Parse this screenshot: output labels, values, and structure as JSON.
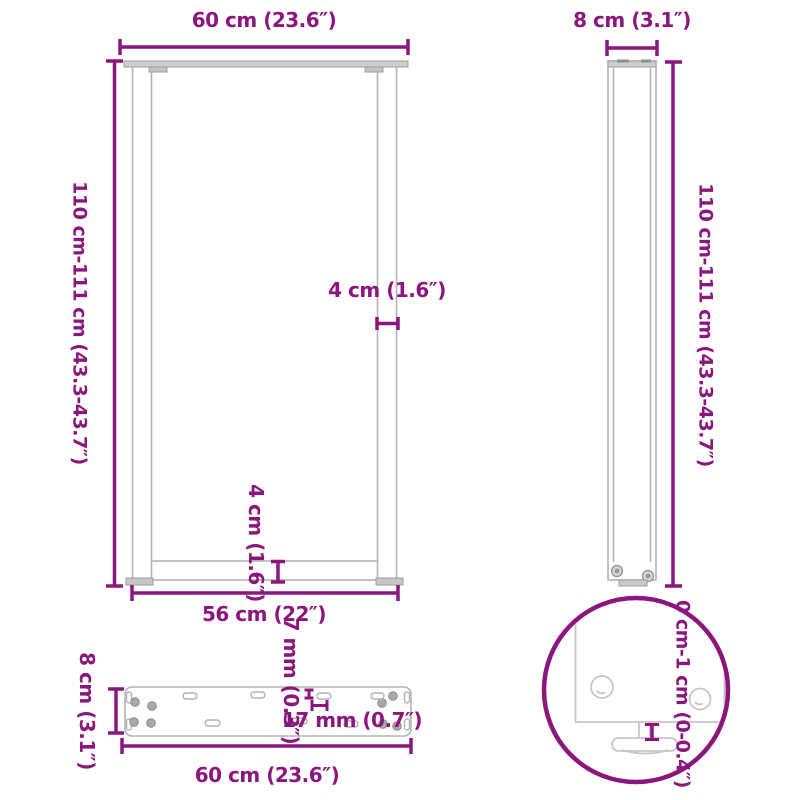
{
  "diagram": {
    "type": "product-dimension-diagram",
    "subject": "U-shaped table legs",
    "colors": {
      "dimension_accent": "#8C157E",
      "drawing_outline": "#B3B3B3",
      "drawing_fill": "#CDCDCD",
      "background": "#FFFFFF"
    },
    "views": {
      "front": {
        "top_width": "60 cm (23.6″)",
        "height_range": "110 cm-111 cm (43.3-43.7″)",
        "tube_width": "4 cm (1.6″)",
        "crossbar_height": "4 cm (1.6″)",
        "inner_width": "56 cm (22″)"
      },
      "side": {
        "depth": "8 cm (3.1″)",
        "height_range": "110 cm-111 cm (43.3-43.7″)"
      },
      "top_plate": {
        "depth": "8 cm (3.1″)",
        "hole_diameter": "7 mm (0.3″)",
        "slot_length": "17 mm (0.7″)",
        "width": "60 cm (23.6″)"
      },
      "foot_detail": {
        "adjustment_range": "0 cm-1 cm (0-0.4″)"
      }
    }
  }
}
